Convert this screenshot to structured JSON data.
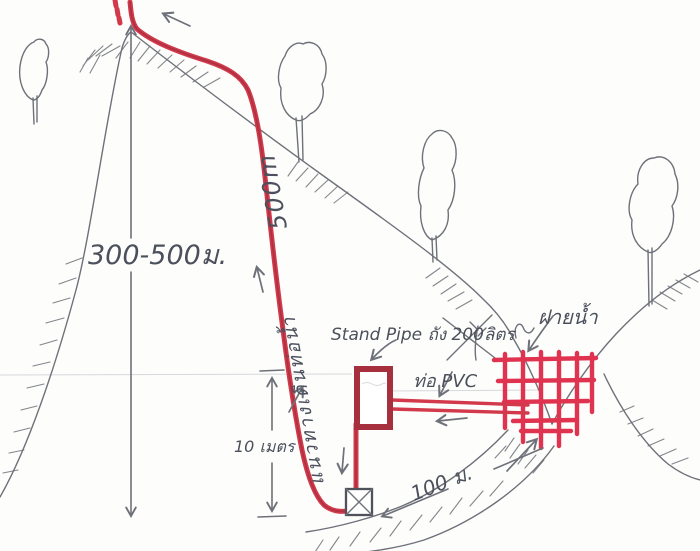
{
  "labels": {
    "elevation": "300-500ม.",
    "pipe_route": "แนวทางเดินท่อน้ำ",
    "pipe_route_length": "500m",
    "stand_pipe": "Stand Pipe ถัง 200ลิตร",
    "pvc_pipe": "ท่อ PVC",
    "weir": "ฝายน้ำ",
    "drop_height": "10 เมตร",
    "distance": "100 ม."
  },
  "colors": {
    "paper": "#fdfdfb",
    "pencil-gray": "#6e7179",
    "text-pencil": "#4b505c",
    "marker-red": "#d23a4c",
    "marker-dark": "#a7303e",
    "grid-red": "#e03350"
  }
}
